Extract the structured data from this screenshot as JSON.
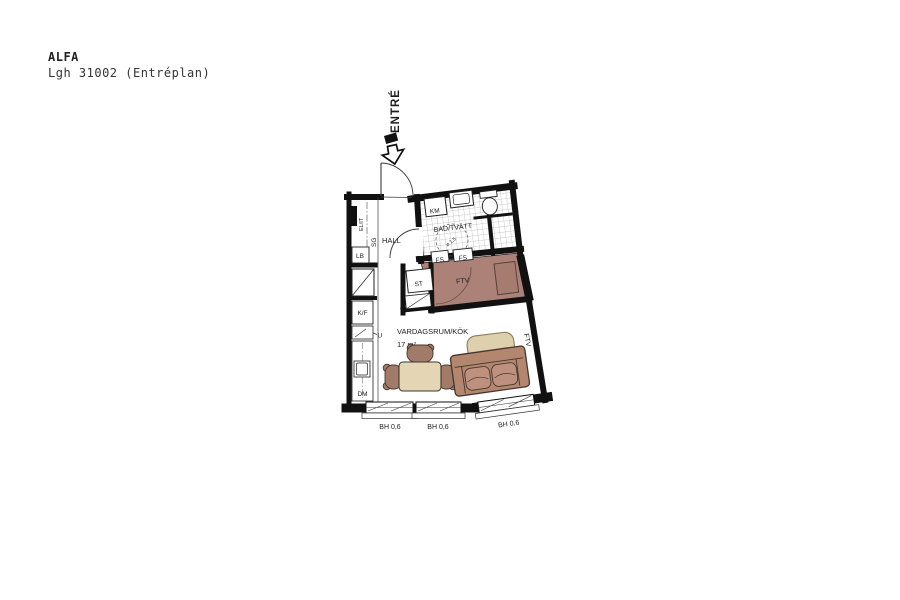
{
  "header": {
    "title": "ALFA",
    "subtitle": "Lgh 31002 (Entréplan)"
  },
  "plan": {
    "entrance_label": "ENTRÉ",
    "rooms": {
      "hall": "HALL",
      "bathroom": "BAD/TVÄTT",
      "living": "VARDAGSRUM/KÖK",
      "living_area": "17 m²",
      "alcove": "FTV"
    },
    "fixtures": {
      "elit": "EL/IT",
      "sg": "SG",
      "lb": "LB",
      "kf": "K/F",
      "oven": "U",
      "dm": "DM",
      "km": "KM",
      "st": "ST",
      "fs_left": "FS",
      "fs_right": "FS",
      "shaft_ftv": "FTV",
      "turning_circle": "ø 1,5"
    },
    "windows": [
      {
        "label": "BH 0,6"
      },
      {
        "label": "BH 0,6"
      },
      {
        "label": "BH 0,6"
      }
    ],
    "colors": {
      "wall": "#111111",
      "alcove_floor": "#ac8278",
      "bed": "#a57c6f",
      "sofa": "#b2866f",
      "cushion": "#bd917d",
      "dining_table": "#e4d6b4",
      "coffee_table": "#ded0ad",
      "chair": "#a27a68"
    }
  }
}
